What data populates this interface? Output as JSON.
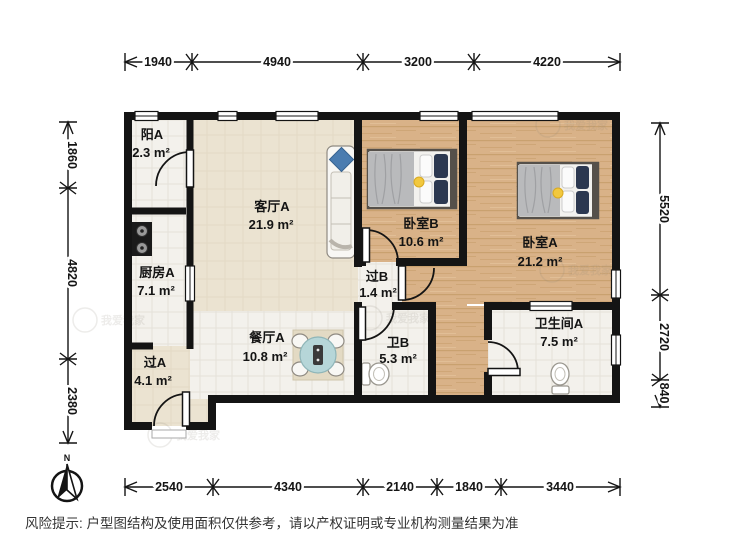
{
  "floorplan": {
    "rooms": {
      "balcony": {
        "name": "阳A",
        "area": "2.3 m²"
      },
      "kitchen": {
        "name": "厨房A",
        "area": "7.1 m²"
      },
      "hall_a": {
        "name": "过A",
        "area": "4.1 m²"
      },
      "living": {
        "name": "客厅A",
        "area": "21.9 m²"
      },
      "dining": {
        "name": "餐厅A",
        "area": "10.8 m²"
      },
      "bedroom_b": {
        "name": "卧室B",
        "area": "10.6 m²"
      },
      "bedroom_a": {
        "name": "卧室A",
        "area": "21.2 m²"
      },
      "hall_b": {
        "name": "过B",
        "area": "1.4 m²"
      },
      "bath_b": {
        "name": "卫B",
        "area": "5.3 m²"
      },
      "bath_a": {
        "name": "卫生间A",
        "area": "7.5 m²"
      }
    },
    "dimensions_mm": {
      "top": [
        "1940",
        "4940",
        "3200",
        "4220"
      ],
      "bottom": [
        "2540",
        "4340",
        "2140",
        "1840",
        "3440"
      ],
      "left": [
        "1860",
        "4820",
        "2380"
      ],
      "right": [
        "5520",
        "2720",
        "840"
      ]
    },
    "compass_label": "N",
    "watermark": "我爱我家"
  },
  "footer": {
    "disclaimer": "风险提示: 户型图结构及使用面积仅供参考，请以产权证明或专业机构测量结果为准"
  }
}
